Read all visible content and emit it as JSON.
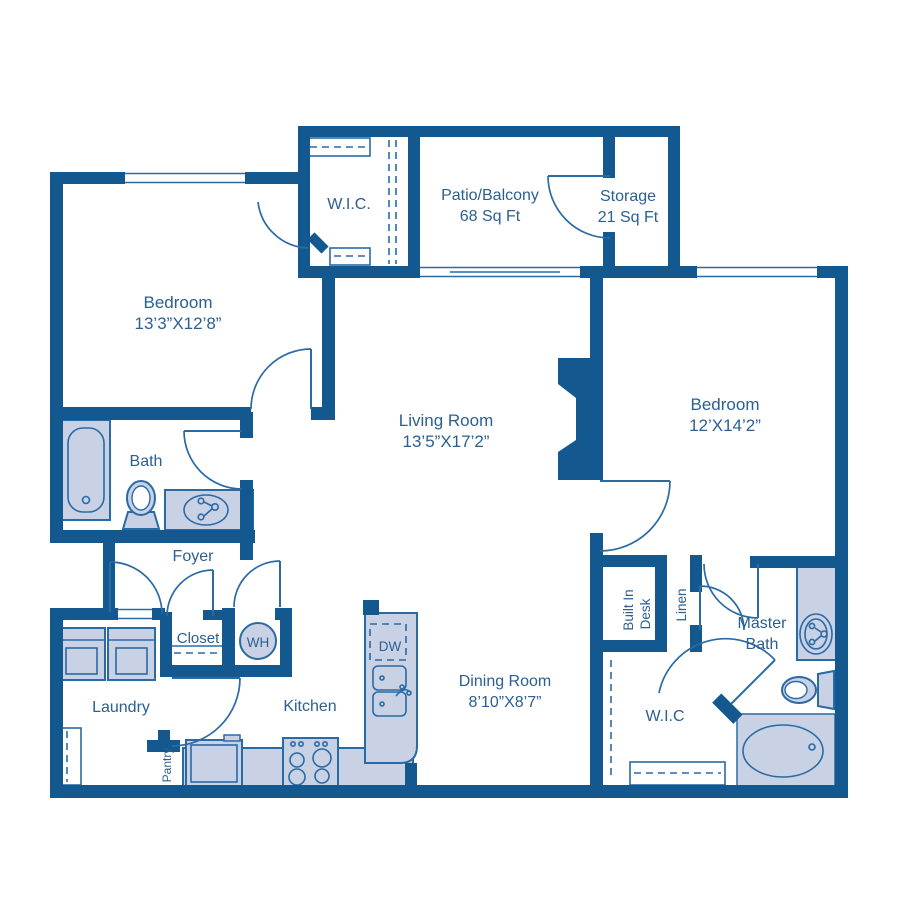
{
  "plan_title": "Two Bedroom Apartment Floor Plan",
  "colors": {
    "wall": "#13598f",
    "line": "#2a6aa5",
    "fixture_fill": "#c9d1e5",
    "text": "#2a6092",
    "background": "#ffffff"
  },
  "rooms": {
    "wic_top": {
      "label": "W.I.C."
    },
    "patio": {
      "label": "Patio/Balcony",
      "area": "68 Sq Ft"
    },
    "storage": {
      "label": "Storage",
      "area": "21 Sq Ft"
    },
    "bedroom1": {
      "label": "Bedroom",
      "dims": "13’3”X12’8”"
    },
    "living": {
      "label": "Living Room",
      "dims": "13’5”X17’2”"
    },
    "bedroom2": {
      "label": "Bedroom",
      "dims": "12’X14’2”"
    },
    "bath": {
      "label": "Bath"
    },
    "foyer": {
      "label": "Foyer"
    },
    "closet": {
      "label": "Closet"
    },
    "laundry": {
      "label": "Laundry"
    },
    "kitchen": {
      "label": "Kitchen"
    },
    "pantry": {
      "label": "Pantry"
    },
    "dining": {
      "label": "Dining Room",
      "dims": "8’10”X8’7”"
    },
    "desk": {
      "line1": "Built In",
      "line2": "Desk"
    },
    "linen": {
      "label": "Linen"
    },
    "master_bath": {
      "line1": "Master",
      "line2": "Bath"
    },
    "wic_bottom": {
      "label": "W.I.C"
    }
  },
  "fixtures": {
    "water_heater": "WH",
    "dishwasher": "DW"
  }
}
